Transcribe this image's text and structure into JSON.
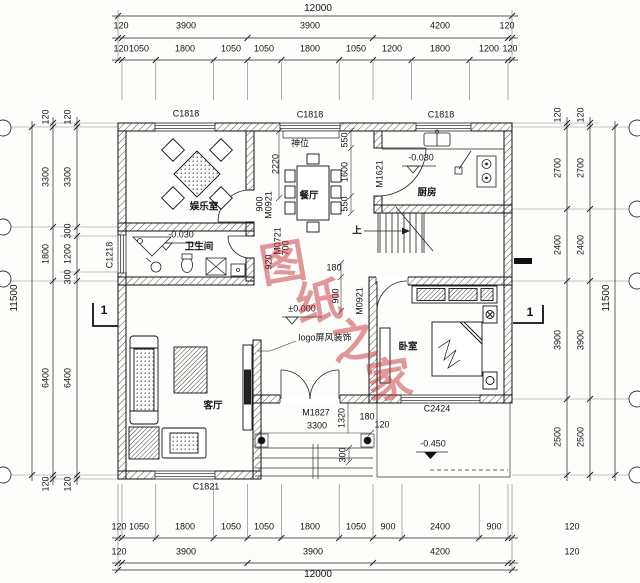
{
  "dims": {
    "top": {
      "overall": "12000",
      "segments": [
        "120",
        "3900",
        "3900",
        "4200",
        "120"
      ],
      "detail": [
        "120",
        "1050",
        "1800",
        "1050",
        "1050",
        "1800",
        "1050",
        "1200",
        "1800",
        "1200",
        "120"
      ]
    },
    "bottom": {
      "overall": "12000",
      "segments": [
        "120",
        "3900",
        "3900",
        "4200",
        "120"
      ],
      "detail": [
        "120",
        "1050",
        "1800",
        "1050",
        "1050",
        "1800",
        "1050",
        "900",
        "2400",
        "900",
        "120"
      ]
    },
    "left": {
      "overall": "11500",
      "major": [
        "120",
        "3300",
        "1800",
        "6400",
        "120"
      ],
      "detail": [
        "120",
        "3300",
        "300",
        "1200",
        "300",
        "6400",
        "120"
      ]
    },
    "right": {
      "overall": "11500",
      "inner": [
        "120",
        "2700",
        "2400",
        "3900",
        "2500"
      ],
      "outer": [
        "120",
        "2700",
        "2400",
        "3900",
        "2500"
      ],
      "corner": [
        "120",
        "120"
      ]
    }
  },
  "rooms": {
    "entertainment": "娱乐室",
    "dining": "餐厅",
    "kitchen": "厨房",
    "bathroom": "卫生间",
    "living": "客厅",
    "bedroom": "卧室",
    "altar": "神位",
    "stair_up": "上"
  },
  "windows": {
    "top_left": "C1818",
    "top_mid": "C1818",
    "top_right": "C1818",
    "bath": "C1218",
    "living": "C1821",
    "bedroom": "C2424"
  },
  "doors": {
    "kitchen": "M1621",
    "entertainment": "M0921",
    "bathroom": "M0721",
    "bedroom": "M0921",
    "entry": "M1827"
  },
  "levels": {
    "ground": "±0.000",
    "indoor_drop": "-0.030",
    "outdoor": "-0.450"
  },
  "inline_dims": {
    "nook_2220": "2220",
    "altar_550": "550",
    "door_1600": "1600",
    "lower_550": "550",
    "ent_door_900": "900",
    "bath_700": "700",
    "bath_920": "920",
    "bed_door_900": "900",
    "bed_door_180": "180",
    "entry_3300": "3300",
    "porch_1320": "1320",
    "porch_180": "180",
    "porch_120": "120",
    "step_300": "300"
  },
  "annotations": {
    "logo_screen": "logo屏风装饰",
    "section_mark": "1",
    "watermark": "图纸之家"
  }
}
